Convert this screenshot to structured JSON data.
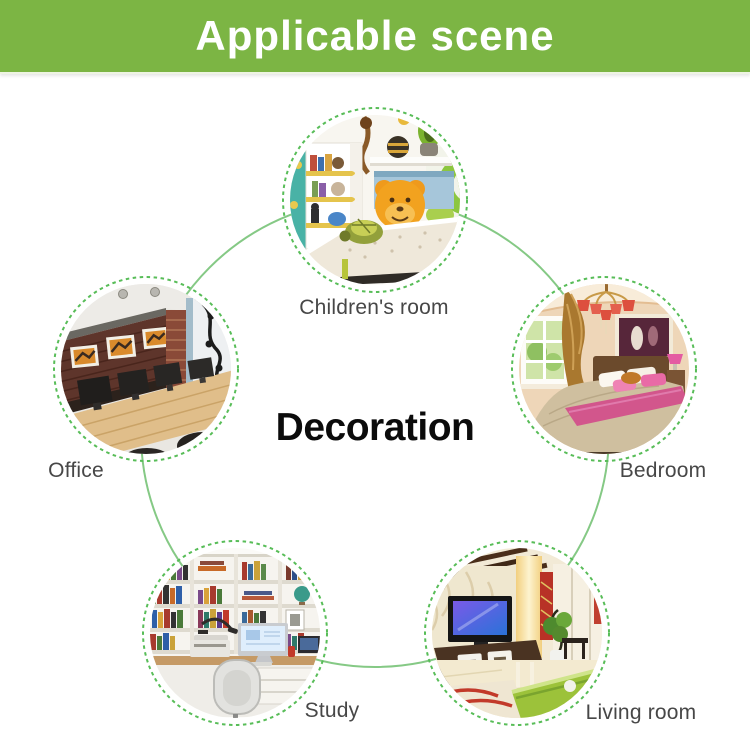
{
  "banner": {
    "title": "Applicable scene",
    "bg_color": "#7cb544",
    "text_color": "#ffffff"
  },
  "diagram": {
    "center_title": "Decoration",
    "connector_color": "#85c985",
    "ring_color": "#58bd58",
    "label_color": "#474747",
    "scenes": [
      {
        "id": "children-room",
        "label": "Children's room",
        "position": "top"
      },
      {
        "id": "bedroom",
        "label": "Bedroom",
        "position": "upper-right"
      },
      {
        "id": "office",
        "label": "Office",
        "position": "upper-left"
      },
      {
        "id": "study",
        "label": "Study",
        "position": "lower-left"
      },
      {
        "id": "living-room",
        "label": "Living room",
        "position": "lower-right"
      }
    ]
  }
}
